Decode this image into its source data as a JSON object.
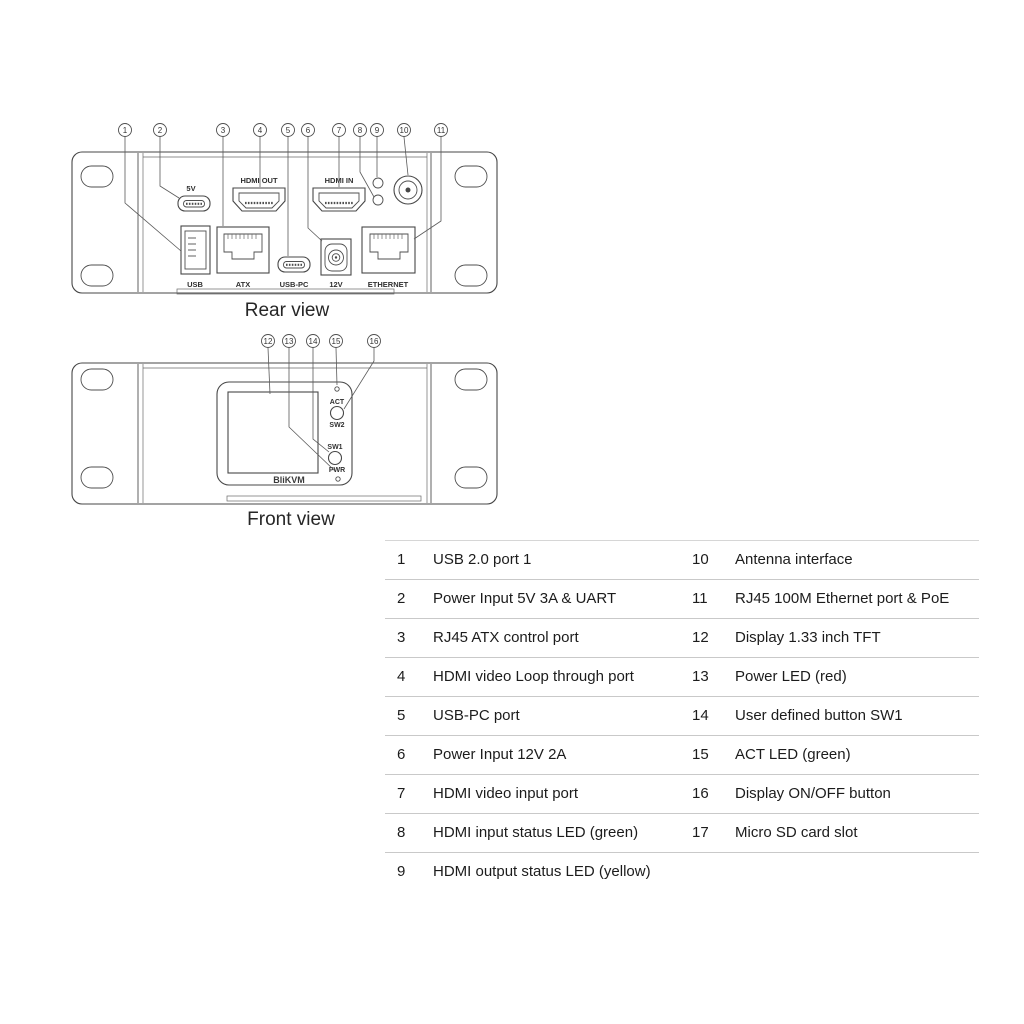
{
  "rear_view": {
    "caption": "Rear view",
    "callouts": [
      "1",
      "2",
      "3",
      "4",
      "5",
      "6",
      "7",
      "8",
      "9",
      "10",
      "11"
    ],
    "port_labels": {
      "power_5v": "5V",
      "hdmi_out": "HDMI OUT",
      "hdmi_in": "HDMI IN",
      "usb": "USB",
      "atx": "ATX",
      "usb_pc": "USB-PC",
      "power_12v": "12V",
      "ethernet": "ETHERNET"
    }
  },
  "front_view": {
    "caption": "Front view",
    "callouts": [
      "12",
      "13",
      "14",
      "15",
      "16"
    ],
    "labels": {
      "act": "ACT",
      "sw2": "SW2",
      "sw1": "SW1",
      "pwr": "PWR",
      "brand": "BliKVM"
    }
  },
  "legend": {
    "rows": [
      {
        "left_num": "1",
        "left_label": "USB 2.0 port 1",
        "right_num": "10",
        "right_label": "Antenna interface"
      },
      {
        "left_num": "2",
        "left_label": "Power Input 5V 3A & UART",
        "right_num": "11",
        "right_label": "RJ45 100M Ethernet port & PoE"
      },
      {
        "left_num": "3",
        "left_label": "RJ45 ATX control port",
        "right_num": "12",
        "right_label": "Display 1.33 inch TFT"
      },
      {
        "left_num": "4",
        "left_label": "HDMI video Loop through port",
        "right_num": "13",
        "right_label": "Power LED (red)"
      },
      {
        "left_num": "5",
        "left_label": "USB-PC port",
        "right_num": "14",
        "right_label": "User defined button SW1"
      },
      {
        "left_num": "6",
        "left_label": "Power Input 12V 2A",
        "right_num": "15",
        "right_label": "ACT LED (green)"
      },
      {
        "left_num": "7",
        "left_label": "HDMI video input port",
        "right_num": "16",
        "right_label": "Display ON/OFF button"
      },
      {
        "left_num": "8",
        "left_label": "HDMI input status LED (green)",
        "right_num": "17",
        "right_label": "Micro SD card slot"
      },
      {
        "left_num": "9",
        "left_label": "HDMI output status LED (yellow)",
        "right_num": "",
        "right_label": ""
      }
    ]
  },
  "colors": {
    "line": "#474747",
    "text": "#1c1c1c",
    "separator": "#c9c9c9",
    "background": "#ffffff"
  }
}
